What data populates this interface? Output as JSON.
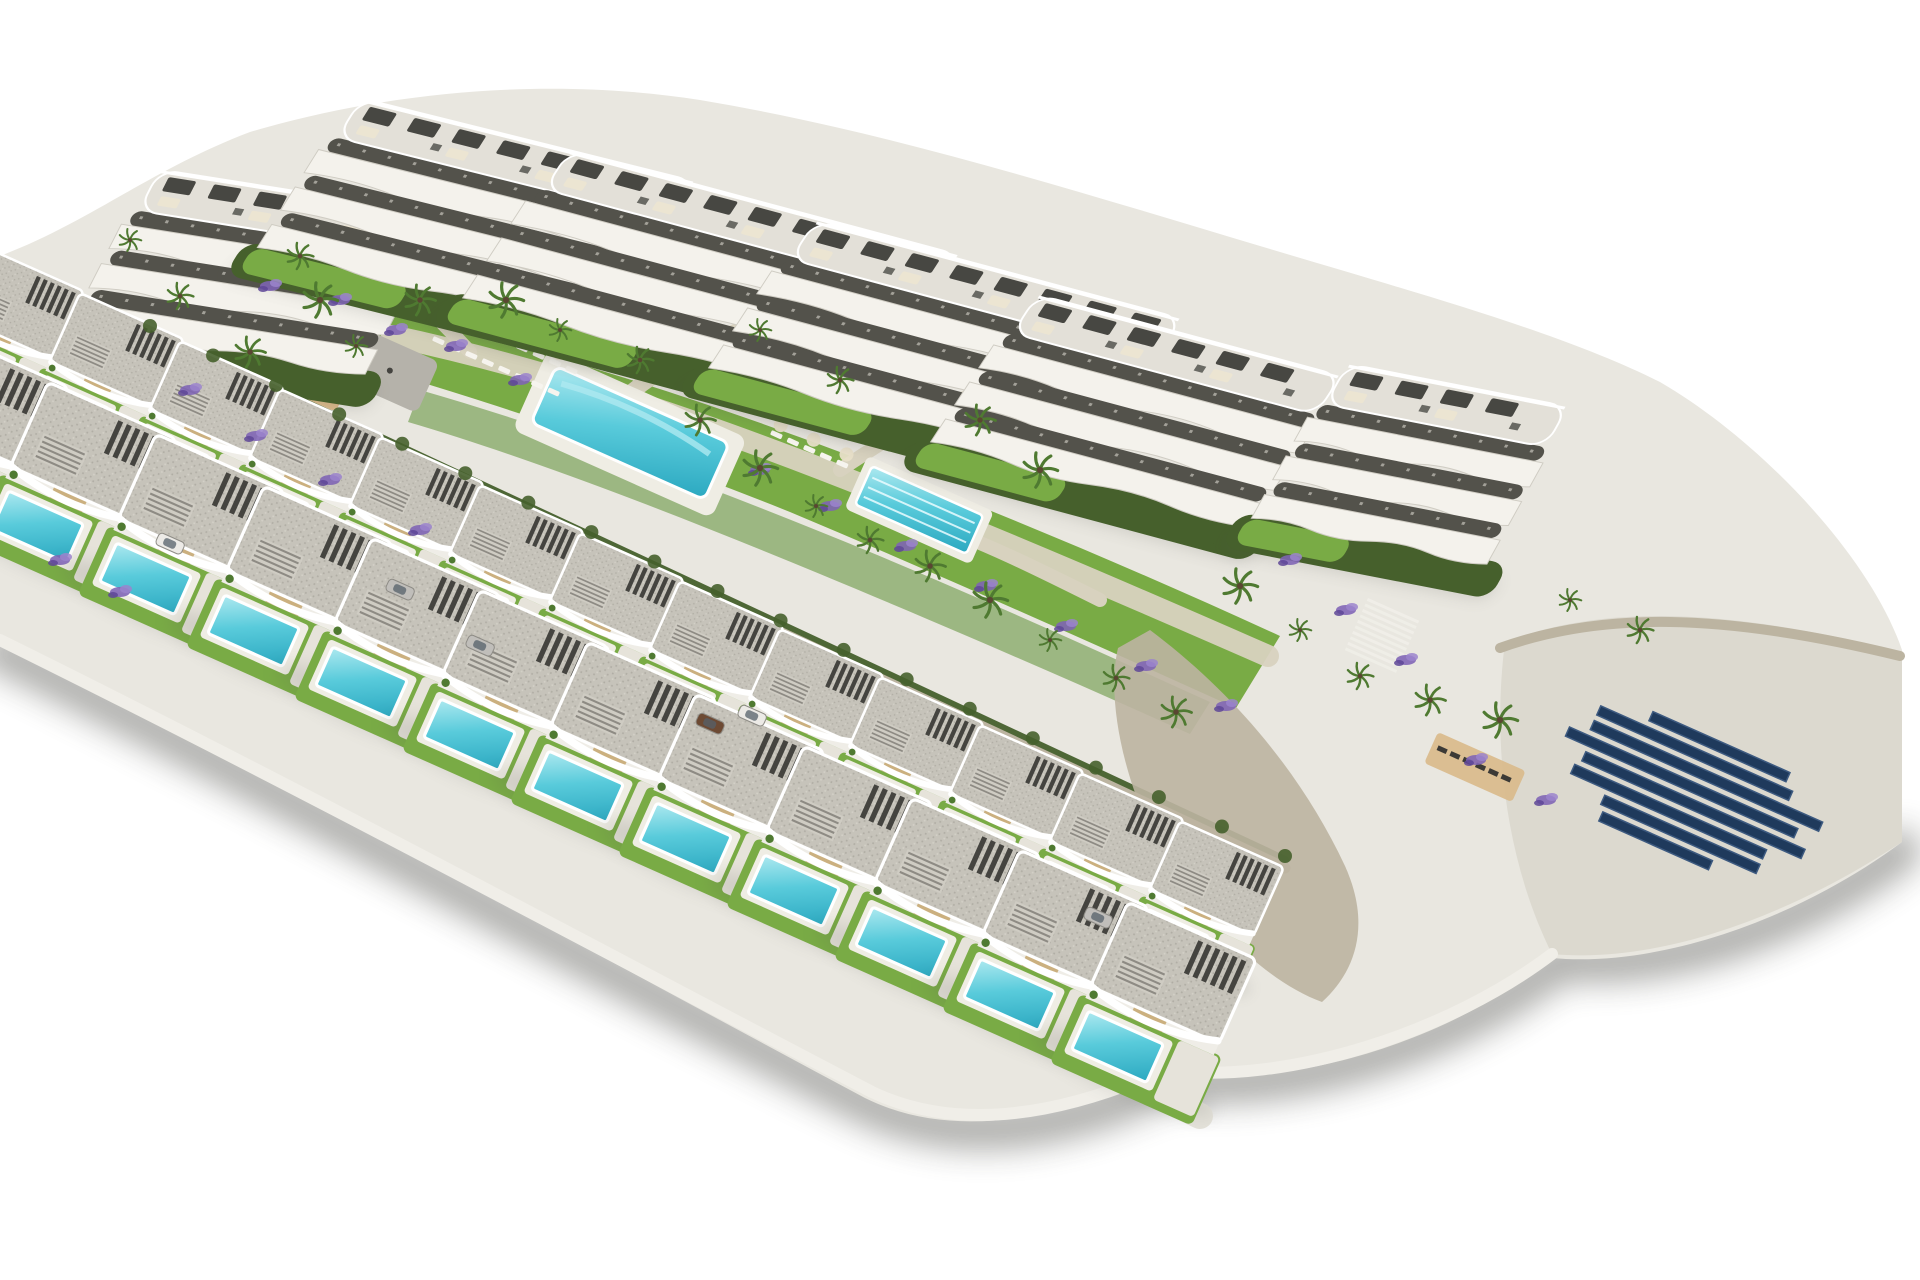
{
  "scene": {
    "type": "architectural-3d-render",
    "description": "Aerial isometric 3D visualization of a hillside residential development isolated on a white background: six white apartment blocks with wavy curved balcony bands and rooftop pergolas along the top, two diagonal rows of modern flat-roof villas with private turquoise pools in the foreground, central communal gardens with a large pool, a lap lane pool, playground pads, beige paths, lavender beds, palm trees, stone retaining walls, stairs, and a navy solar-panel array on the right. Soft grey shadows fade into the white ground.",
    "background": "#ffffff",
    "projection": "oblique aerial"
  },
  "colors": {
    "background": "#ffffff",
    "concrete_light": "#e9e7e0",
    "terrace_base": "#e3e0d8",
    "facade_white": "#f4f2ec",
    "band_stroke": "#cfccc3",
    "terrace_shadow": "#53524b",
    "roof_grey": "#c6c3ba",
    "roof_speckle": "#b0ada4",
    "pergola_dark": "#3a3a35",
    "lawn": "#79ab45",
    "lawn_dark": "#5d8f35",
    "hedge": "#46602c",
    "foliage": "#4f7a31",
    "path_beige": "#d8d2bf",
    "road_grey": "#e4e2da",
    "wall_light": "#f0eee8",
    "sand": "#d9b98a",
    "pad_grey": "#b5b2aa",
    "pad_light": "#dcd9cf",
    "stone_wall": "#bcb4a1",
    "pool_light": "#aee9f0",
    "pool_mid": "#59cbdb",
    "pool_deep": "#2ba8c0",
    "pool_deck": "#efede4",
    "lavender": "#7e63b5",
    "lavender_light": "#9b84cc",
    "lavender_dark": "#5e4796",
    "solar_navy": "#1f3a5c",
    "solar_edge": "#3d5a80",
    "shadow": "#55544f",
    "accent_tan": "#cbb07f",
    "car_brown": "#6d4a33",
    "car_white": "#eceae6",
    "car_silver": "#c0beba"
  },
  "inventory": {
    "apartment_blocks": 6,
    "villas": 25,
    "private_pools": 25,
    "communal_pools": 2,
    "lap_pool_lanes": 3,
    "solar_panel_rows": 8,
    "playground_pads": 2,
    "staircases": 1,
    "sun_deck_loungers": 6,
    "cars": 6,
    "palm_trees": 30,
    "lavender_beds": 23
  },
  "apartment_blocks": [
    {
      "x": 150,
      "y": 168,
      "rot": 9,
      "len": 300
    },
    {
      "x": 352,
      "y": 96,
      "rot": 14,
      "len": 360
    },
    {
      "x": 560,
      "y": 148,
      "rot": 15,
      "len": 420
    },
    {
      "x": 806,
      "y": 218,
      "rot": 15,
      "len": 395
    },
    {
      "x": 1028,
      "y": 292,
      "rot": 15,
      "len": 330
    },
    {
      "x": 1338,
      "y": 362,
      "rot": 11,
      "len": 240
    }
  ],
  "villas": {
    "back": {
      "scale": 0.85,
      "rot": 24,
      "positions": [
        [
          -20,
          245
        ],
        [
          80,
          293
        ],
        [
          180,
          341
        ],
        [
          280,
          389
        ],
        [
          380,
          437
        ],
        [
          480,
          485
        ],
        [
          580,
          533
        ],
        [
          680,
          581
        ],
        [
          780,
          629
        ],
        [
          880,
          677
        ],
        [
          980,
          725
        ],
        [
          1080,
          773
        ],
        [
          1180,
          821
        ]
      ]
    },
    "front": {
      "scale": 1.05,
      "rot": 24,
      "positions": [
        [
          -60,
          330
        ],
        [
          48,
          382
        ],
        [
          156,
          434
        ],
        [
          264,
          486
        ],
        [
          372,
          538
        ],
        [
          480,
          590
        ],
        [
          588,
          642
        ],
        [
          696,
          694
        ],
        [
          804,
          746
        ],
        [
          912,
          798
        ],
        [
          1020,
          850
        ],
        [
          1128,
          902
        ]
      ]
    }
  },
  "pools": {
    "main": {
      "x": 556,
      "y": 366,
      "rot": 24,
      "w": 190,
      "h": 62
    },
    "lap": {
      "x": 872,
      "y": 466,
      "rot": 24,
      "w": 122,
      "h": 42,
      "lanes": 3
    }
  },
  "playground": {
    "sand": {
      "x": 268,
      "y": 338,
      "rot": 24,
      "w": 92,
      "h": 40
    },
    "pad": {
      "x": 372,
      "y": 332,
      "rot": 24,
      "w": 74,
      "h": 56
    }
  },
  "stairs": [
    {
      "x": 1368,
      "y": 598,
      "rot": 24,
      "steps": 10,
      "w": 56
    }
  ],
  "sun_deck": {
    "x": 1438,
    "y": 732,
    "rot": 24,
    "loungers": 6
  },
  "lounger_rows": [
    {
      "x": 452,
      "y": 314,
      "rot": 24,
      "count": 8,
      "parasols": true
    },
    {
      "x": 434,
      "y": 336,
      "rot": 24,
      "count": 8,
      "parasols": false
    },
    {
      "x": 772,
      "y": 430,
      "rot": 24,
      "count": 5,
      "parasols": true
    }
  ],
  "solar_array": {
    "x": 1600,
    "y": 688,
    "rot": 24,
    "row_h": 10,
    "gap": 16,
    "rows": [
      150,
      210,
      250,
      250,
      240,
      210,
      170,
      120
    ]
  },
  "cars": [
    {
      "x": 160,
      "y": 532,
      "color": "car_white"
    },
    {
      "x": 390,
      "y": 578,
      "color": "car_silver"
    },
    {
      "x": 700,
      "y": 712,
      "color": "car_brown"
    },
    {
      "x": 742,
      "y": 704,
      "color": "car_white"
    },
    {
      "x": 470,
      "y": 634,
      "color": "car_silver"
    },
    {
      "x": 1088,
      "y": 906,
      "color": "car_silver"
    }
  ],
  "palms": [
    [
      130,
      240
    ],
    [
      180,
      296
    ],
    [
      250,
      352
    ],
    [
      320,
      300
    ],
    [
      356,
      346
    ],
    [
      300,
      256
    ],
    [
      420,
      300
    ],
    [
      506,
      300
    ],
    [
      560,
      330
    ],
    [
      640,
      360
    ],
    [
      700,
      420
    ],
    [
      760,
      468
    ],
    [
      816,
      506
    ],
    [
      870,
      540
    ],
    [
      930,
      566
    ],
    [
      990,
      600
    ],
    [
      1050,
      640
    ],
    [
      1116,
      678
    ],
    [
      1176,
      712
    ],
    [
      1240,
      586
    ],
    [
      1300,
      630
    ],
    [
      1360,
      676
    ],
    [
      1430,
      700
    ],
    [
      1500,
      720
    ],
    [
      1570,
      600
    ],
    [
      1640,
      630
    ],
    [
      980,
      420
    ],
    [
      1040,
      470
    ],
    [
      760,
      330
    ],
    [
      840,
      380
    ]
  ],
  "lavender_beds": [
    [
      340,
      300
    ],
    [
      396,
      330
    ],
    [
      270,
      286
    ],
    [
      456,
      346
    ],
    [
      520,
      380
    ],
    [
      190,
      390
    ],
    [
      256,
      436
    ],
    [
      330,
      480
    ],
    [
      420,
      530
    ],
    [
      760,
      470
    ],
    [
      830,
      506
    ],
    [
      906,
      546
    ],
    [
      986,
      586
    ],
    [
      1066,
      626
    ],
    [
      1146,
      666
    ],
    [
      1226,
      706
    ],
    [
      1290,
      560
    ],
    [
      1346,
      610
    ],
    [
      1406,
      660
    ],
    [
      60,
      560
    ],
    [
      120,
      592
    ],
    [
      1476,
      760
    ],
    [
      1546,
      800
    ]
  ]
}
